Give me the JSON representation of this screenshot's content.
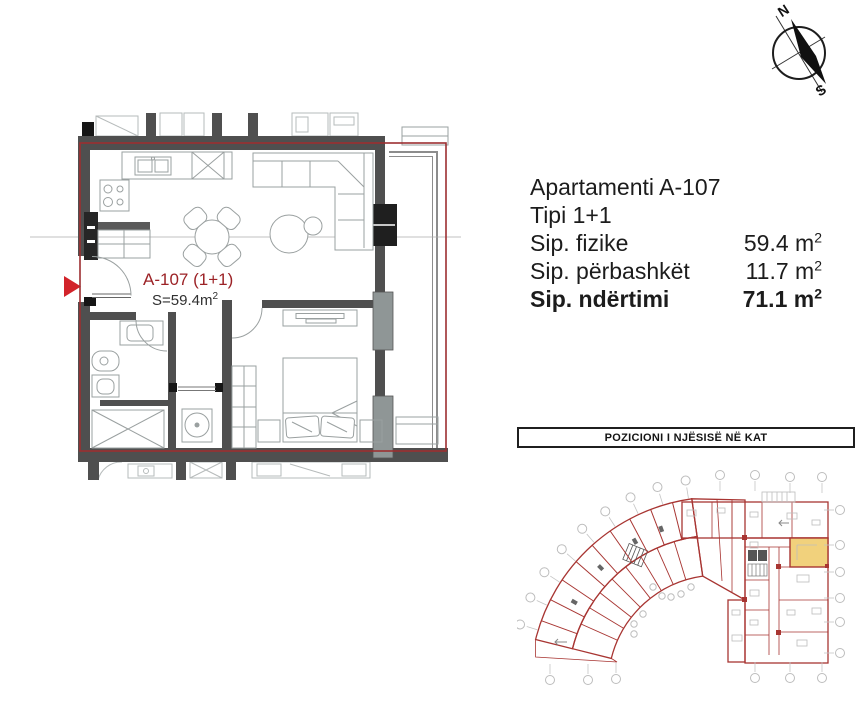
{
  "colors": {
    "accent_red": "#9c2f31",
    "entrance_marker_red": "#d2232a",
    "wall_gray": "#4f4f4f",
    "furniture_line_gray": "#9aa0a0",
    "mini_plan_red": "#a83532",
    "highlight_yellow": "#f1d17c",
    "text": "#1c1c1c"
  },
  "compass": {
    "north_label": "N",
    "south_label": "S"
  },
  "plan": {
    "unit_label": "A-107 (1+1)",
    "area_label": "S=59.4m",
    "area_sup": "2"
  },
  "info": {
    "title": "Apartamenti A-107",
    "type": "Tipi 1+1",
    "rows": [
      {
        "label": "Sip. fizike",
        "value": "59.4 m",
        "sup": "2"
      },
      {
        "label": "Sip. përbashkët",
        "value": "11.7 m",
        "sup": "2"
      },
      {
        "label": "Sip. ndërtimi",
        "value": "71.1 m",
        "sup": "2"
      }
    ]
  },
  "position_panel": {
    "title": "POZICIONI I NJËSISË NË KAT"
  }
}
